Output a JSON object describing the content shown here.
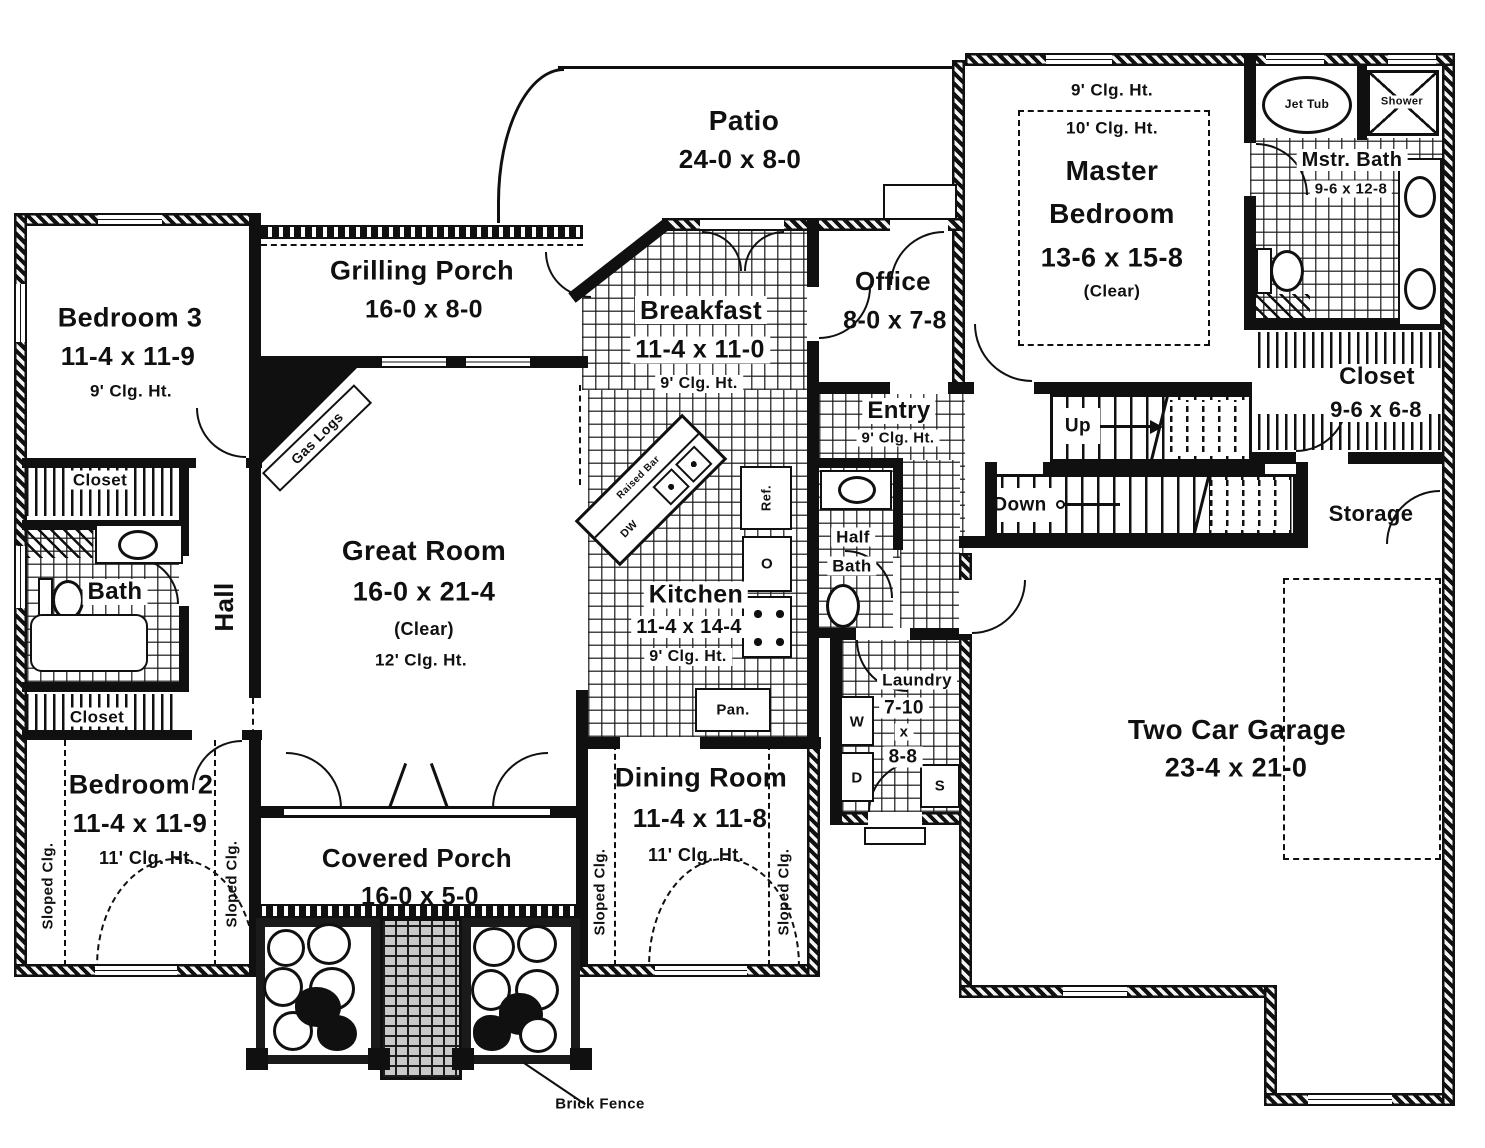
{
  "rooms": {
    "patio": {
      "name": "Patio",
      "dims": "24-0 x 8-0"
    },
    "grilling_porch": {
      "name": "Grilling Porch",
      "dims": "16-0 x 8-0"
    },
    "bedroom3": {
      "name": "Bedroom 3",
      "dims": "11-4 x 11-9",
      "clg": "9' Clg. Ht."
    },
    "closet3": {
      "name": "Closet"
    },
    "bath": {
      "name": "Bath"
    },
    "hall": {
      "name": "Hall"
    },
    "closet2": {
      "name": "Closet"
    },
    "bedroom2": {
      "name": "Bedroom 2",
      "dims": "11-4 x 11-9",
      "clg": "11' Clg. Ht.",
      "sloped": "Sloped Clg."
    },
    "great_room": {
      "name": "Great Room",
      "dims": "16-0 x 21-4",
      "note": "(Clear)",
      "clg": "12' Clg. Ht.",
      "gas_logs": "Gas Logs"
    },
    "breakfast": {
      "name": "Breakfast",
      "dims": "11-4 x 11-0",
      "clg": "9' Clg. Ht."
    },
    "office": {
      "name": "Office",
      "dims": "8-0 x 7-8"
    },
    "entry": {
      "name": "Entry",
      "clg": "9' Clg. Ht."
    },
    "kitchen": {
      "name": "Kitchen",
      "dims": "11-4 x 14-4",
      "clg": "9' Clg. Ht.",
      "raised_bar": "Raised Bar",
      "dw": "DW",
      "ref": "Ref.",
      "oven": "O",
      "pantry": "Pan."
    },
    "half_bath": {
      "line1": "Half",
      "line2": "Bath"
    },
    "laundry": {
      "name": "Laundry",
      "d1": "7-10",
      "dx": "x",
      "d2": "8-8",
      "washer": "W",
      "dryer": "D",
      "sink": "S"
    },
    "dining": {
      "name": "Dining Room",
      "dims": "11-4 x 11-8",
      "clg": "11' Clg. Ht.",
      "sloped": "Sloped Clg."
    },
    "covered_porch": {
      "name": "Covered Porch",
      "dims": "16-0 x 5-0"
    },
    "garage": {
      "name": "Two Car Garage",
      "dims": "23-4 x 21-0"
    },
    "storage": {
      "name": "Storage"
    },
    "master_bedroom": {
      "clg1": "9' Clg. Ht.",
      "clg2": "10' Clg. Ht.",
      "name1": "Master",
      "name2": "Bedroom",
      "dims": "13-6 x 15-8",
      "note": "(Clear)"
    },
    "master_bath": {
      "name": "Mstr. Bath",
      "dims": "9-6 x 12-8",
      "jet_tub": "Jet Tub",
      "shower": "Shower"
    },
    "master_closet": {
      "name": "Closet",
      "dims": "9-6 x 6-8"
    }
  },
  "stairs": {
    "up": "Up",
    "down": "Down"
  },
  "annotations": {
    "brick_fence": "Brick Fence"
  },
  "colors": {
    "ink": "#101010",
    "paper": "#ffffff"
  }
}
